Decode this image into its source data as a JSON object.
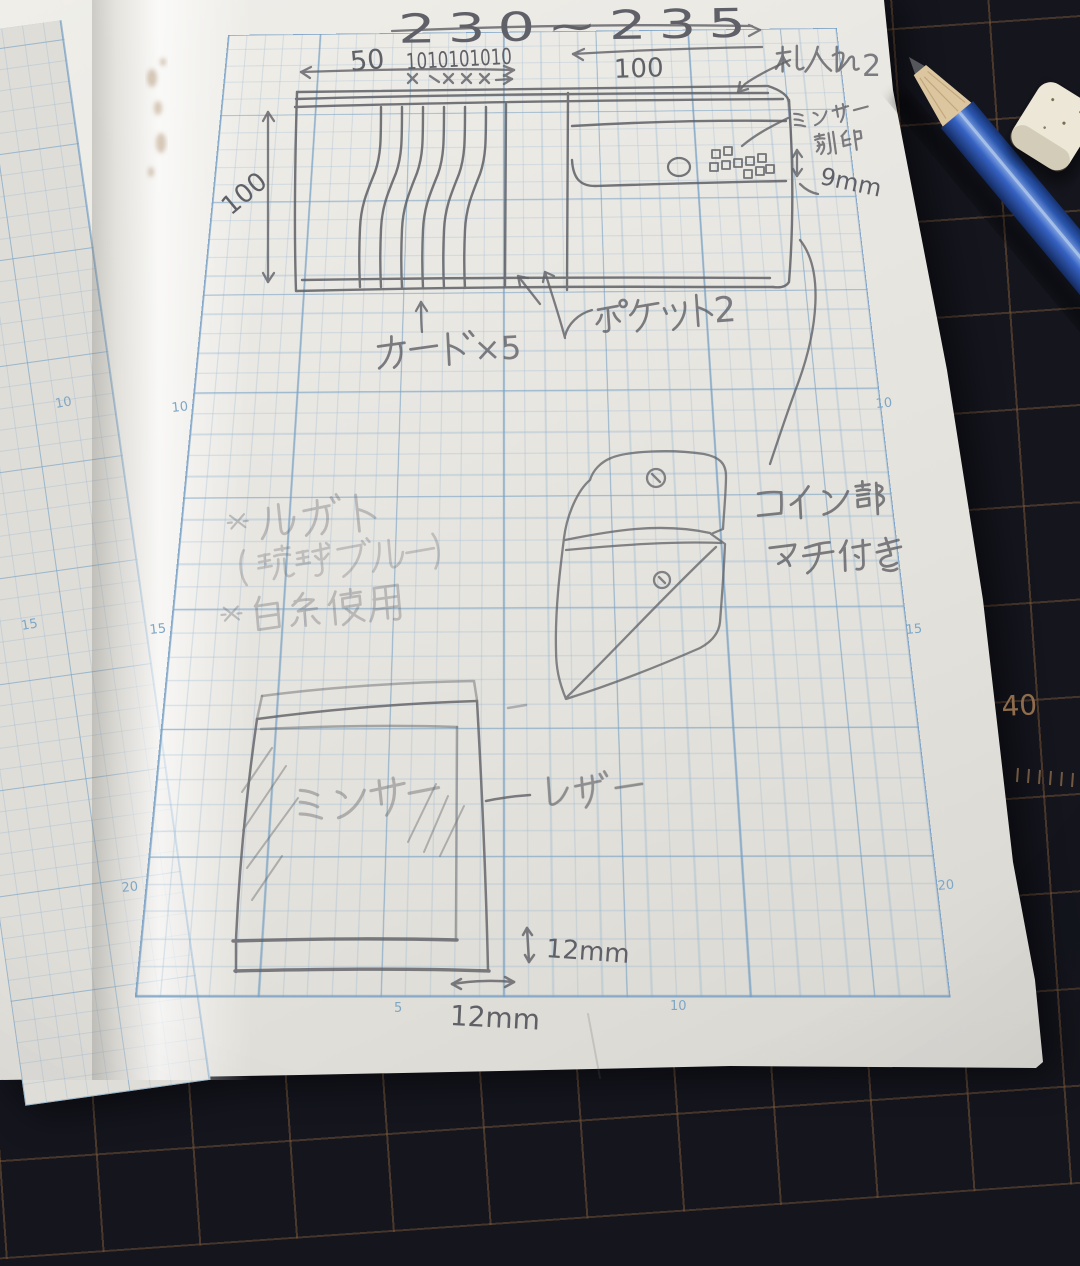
{
  "photo": {
    "mat": {
      "ruler_number": "40"
    },
    "tools": {
      "pencil": "blue-pencil",
      "eraser": "white-eraser"
    },
    "page": {
      "dims": {
        "top_width": "230~235",
        "card_seg": "50",
        "card_tens": "1010101010",
        "height_left": "100",
        "width_right": "100",
        "stamp_size": "9mm",
        "edge_v": "12mm",
        "edge_h": "12mm"
      },
      "labels": {
        "bill": "札入れ2",
        "bill_num": "2",
        "minsa_top": "ミンサー",
        "stamp": "刻印",
        "pocket": "ポケット2",
        "pocket_num": "2",
        "cards": "カード×5",
        "cards_count": "×5",
        "coin1": "コイン部",
        "coin2": "マチ付き",
        "note1": "※ルガト",
        "note2": "（琉球ブルー）",
        "note3": "※白糸使用",
        "minsa_bottom": "ミンサー",
        "leather": "レザー"
      },
      "grid_numbers": {
        "left": [
          "10",
          "15",
          "20"
        ],
        "right": [
          "10",
          "15",
          "20"
        ],
        "bottom": [
          "5",
          "10"
        ],
        "facing": [
          "10",
          "15"
        ]
      }
    }
  }
}
